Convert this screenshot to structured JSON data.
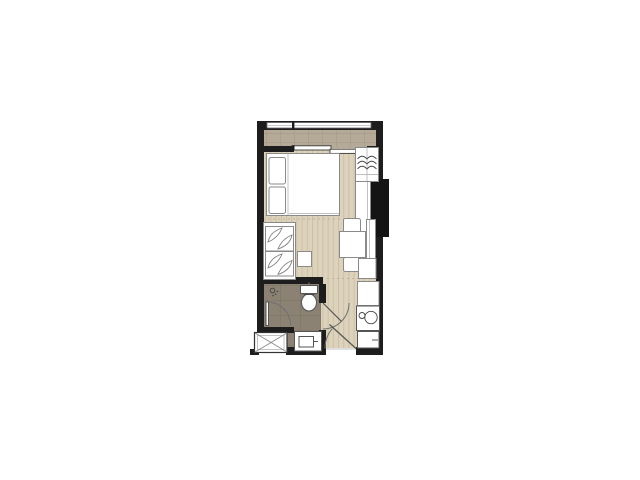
{
  "canvas": {
    "width": 640,
    "height": 480,
    "background": "#ffffff"
  },
  "palette": {
    "wall": "#1d1d1d",
    "column": "#141414",
    "wood_floor": "#ddd3bc",
    "wood_stripe": "#ccc0a6",
    "balcony_tile": "#b4aa97",
    "balcony_grout": "#9b917f",
    "bath_tile": "#8b8274",
    "bath_grout": "#766d5f",
    "furniture_fill": "#ffffff",
    "furniture_stroke": "#8a8a8a",
    "door_arc": "#6f6f6f"
  },
  "plan": {
    "type": "studio-apartment-floor-plan",
    "rooms": [
      {
        "id": "balcony"
      },
      {
        "id": "bedroom-living-room"
      },
      {
        "id": "dining-nook"
      },
      {
        "id": "bathroom"
      },
      {
        "id": "entry-hall-kitchen"
      },
      {
        "id": "service-ledge"
      }
    ],
    "fixtures": [
      {
        "id": "window-band"
      },
      {
        "id": "sliding-glass-door"
      },
      {
        "id": "double-bed-with-pillows"
      },
      {
        "id": "wardrobe-with-hangers"
      },
      {
        "id": "desk-counter"
      },
      {
        "id": "structural-column"
      },
      {
        "id": "dining-table-with-two-chairs"
      },
      {
        "id": "tall-wall-cabinet"
      },
      {
        "id": "base-cabinet"
      },
      {
        "id": "sofa-with-leaf-cushions"
      },
      {
        "id": "side-table"
      },
      {
        "id": "toilet"
      },
      {
        "id": "shower-head"
      },
      {
        "id": "shower-pivot-door"
      },
      {
        "id": "bathroom-door"
      },
      {
        "id": "vanity-sink"
      },
      {
        "id": "ac-condenser-ledge"
      },
      {
        "id": "kitchen-counter"
      },
      {
        "id": "sink-and-hob-unit"
      },
      {
        "id": "refrigerator"
      },
      {
        "id": "entrance-door"
      }
    ]
  }
}
